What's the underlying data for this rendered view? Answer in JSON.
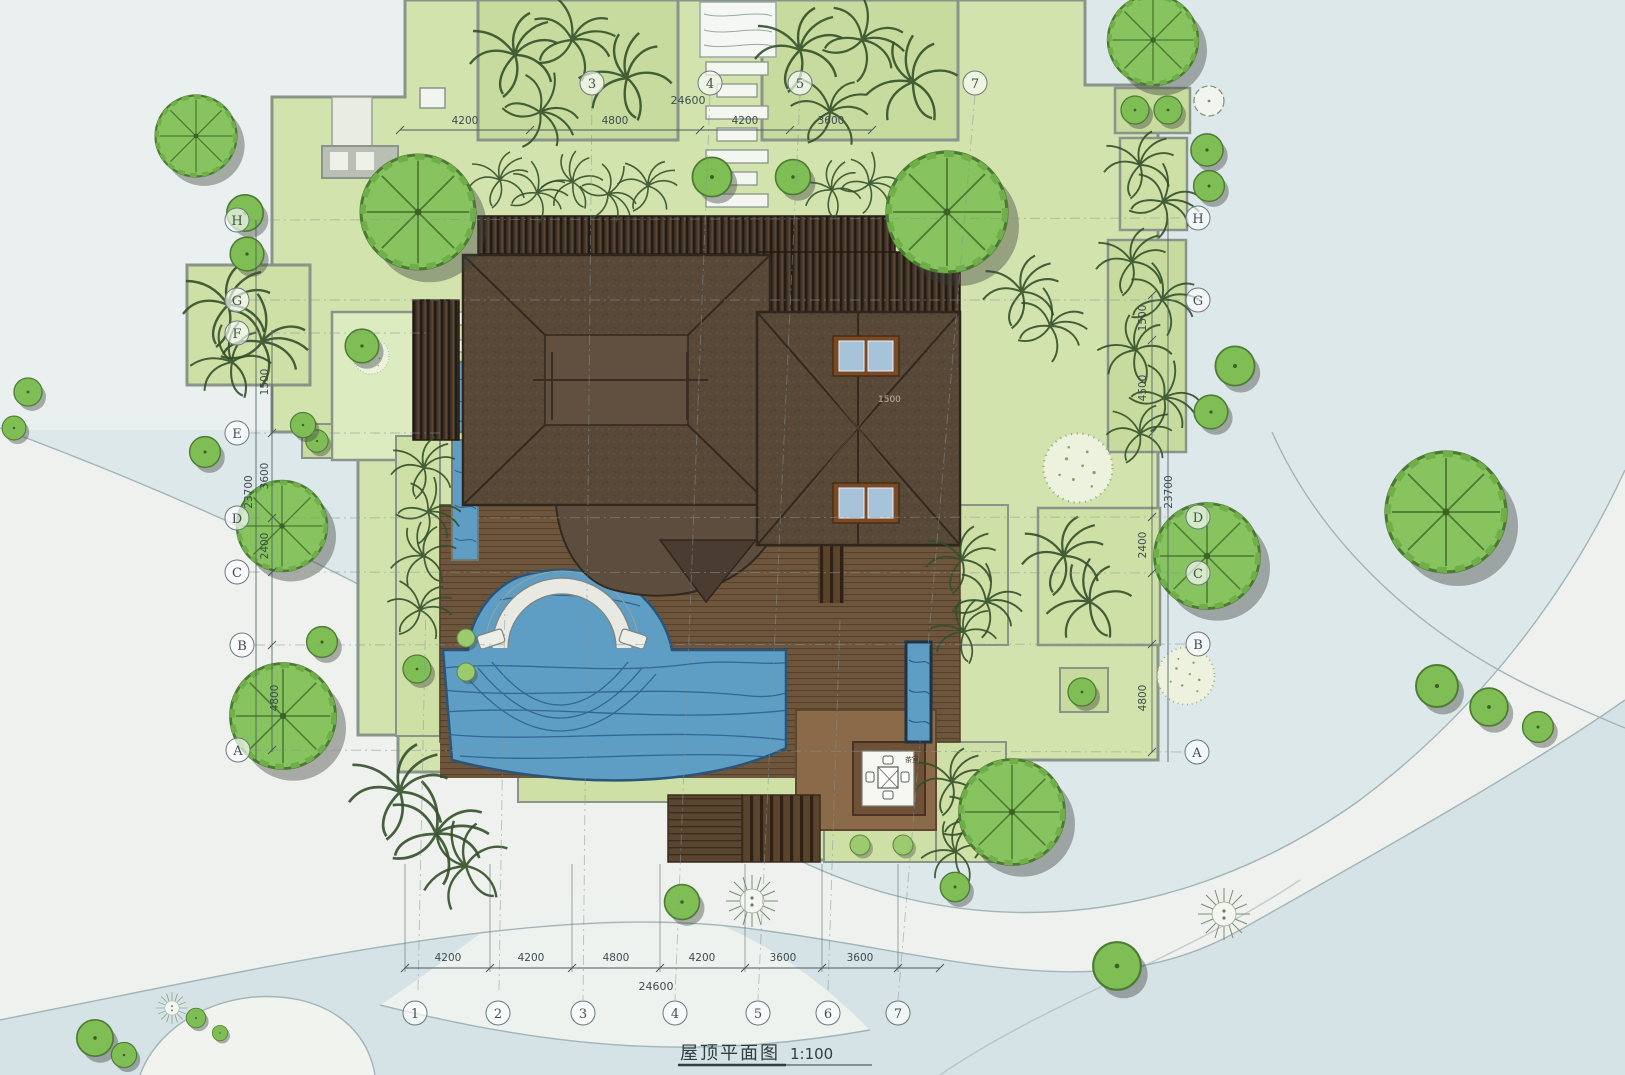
{
  "title_block": {
    "title": "屋顶平面图",
    "scale": "1:100"
  },
  "grid": {
    "top": [
      "3",
      "4",
      "5",
      "7"
    ],
    "bottom": [
      "1",
      "2",
      "3",
      "4",
      "5",
      "6",
      "7"
    ],
    "left": [
      "H",
      "G",
      "F",
      "E",
      "D",
      "C",
      "B",
      "A"
    ],
    "right": [
      "H",
      "G",
      "D",
      "C",
      "B",
      "A"
    ]
  },
  "dimensions": {
    "top": {
      "total": "24600",
      "segments": [
        "4200",
        "4800",
        "4200",
        "3600"
      ]
    },
    "bottom": {
      "total": "24600",
      "segments": [
        "4200",
        "4200",
        "4800",
        "4200",
        "3600",
        "3600"
      ]
    },
    "left": {
      "overall": "23700",
      "segments": [
        "1500",
        "3600",
        "2400",
        "4800"
      ]
    },
    "right": {
      "overall": "23700",
      "segments": [
        "1500",
        "4500",
        "2400",
        "4800"
      ]
    },
    "roof": "1500"
  },
  "annotations": {
    "tea_room": "茶室"
  },
  "colors": {
    "water_bg": "#dde8ea",
    "sand": "#eef1ed",
    "shoreline": "#a3b3b6",
    "plot_green": "#d3e3ad",
    "planter_green": "#c6db9d",
    "tree_green": "#85c05c",
    "roof_brown": "#584838",
    "pergola_brown": "#3f3227",
    "deck_brown": "#6e563d",
    "pool_blue": "#5e9dc4",
    "wall_grey": "#8a948a",
    "skylight_pane": "#a6c3da"
  }
}
